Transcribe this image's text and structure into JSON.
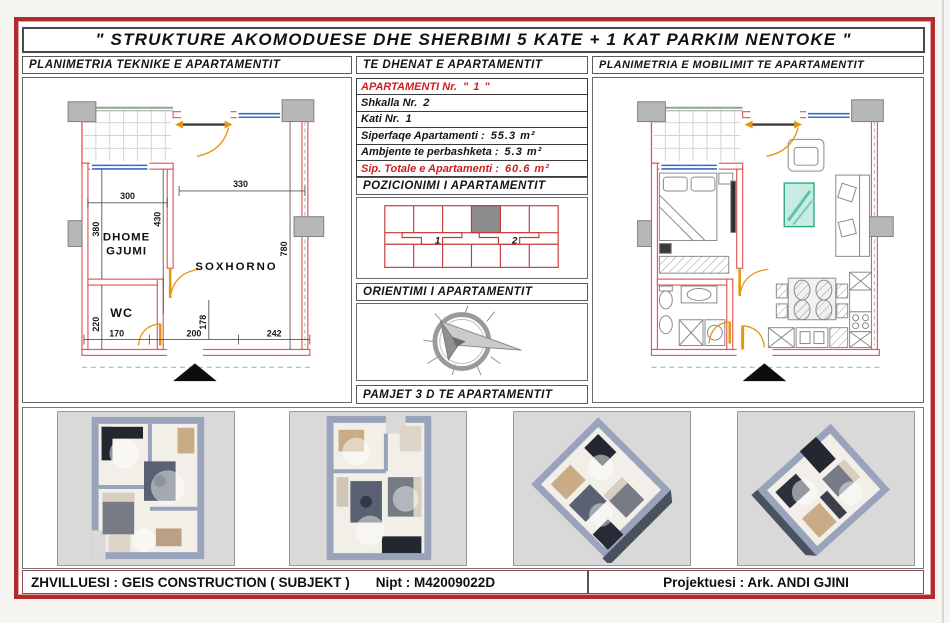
{
  "title": "\" STRUKTURE  AKOMODUESE  DHE  SHERBIMI  5  KATE  +  1 KAT  PARKIM  NENTOKE \"",
  "headers": {
    "technical": "PLANIMETRIA  TEKNIKE  E  APARTAMENTIT",
    "data": "TE  DHENAT  E  APARTAMENTIT",
    "furnishing": "PLANIMETRIA  E  MOBILIMIT  TE  APARTAMENTIT",
    "positioning": "POZICIONIMI  I  APARTAMENTIT",
    "orientation": "ORIENTIMI  I  APARTAMENTIT",
    "views3d": "PAMJET  3 D  TE  APARTAMENTIT"
  },
  "apartment": {
    "rows": [
      {
        "label": "APARTAMENTI   Nr.",
        "value": "\" 1 \""
      },
      {
        "label": "Shkalla    Nr.",
        "value": "2"
      },
      {
        "label": "Kati   Nr.",
        "value": "1"
      },
      {
        "label": "Siperfaqe  Apartamenti :",
        "value": "55.3  m²"
      },
      {
        "label": "Ambjente  te  perbashketa :",
        "value": "5.3  m²"
      },
      {
        "label": "Sip. Totale e Apartamenti :",
        "value": "60.6  m²"
      }
    ]
  },
  "positioning": {
    "stair_1": "1",
    "stair_2": "2"
  },
  "plan": {
    "rooms": {
      "bedroom_line1": "DHOME",
      "bedroom_line2": "GJUMI",
      "living": "SOXHORNO",
      "wc": "WC"
    },
    "dims": {
      "top_right": "330",
      "top_left": "300",
      "left_upper": "380",
      "mid": "430",
      "right": "780",
      "left_lower": "220",
      "bottom_1": "170",
      "bottom_2": "200",
      "bottom_mid": "178",
      "bottom_3": "242"
    }
  },
  "footer": {
    "developer": "ZHVILLUESI : GEIS  CONSTRUCTION ( SUBJEKT )",
    "nipt": "Nipt : M42009022D",
    "designer": "Projektuesi : Ark. ANDI  GJINI"
  },
  "colors": {
    "frame": "#b22a2a",
    "accent_red": "#cc1f1f",
    "wall_red": "#e25b5b",
    "window_blue": "#3c6cc0",
    "door_orange": "#e8960f",
    "column_grey": "#b7b7b7",
    "glass_teal": "#2aa98a"
  }
}
